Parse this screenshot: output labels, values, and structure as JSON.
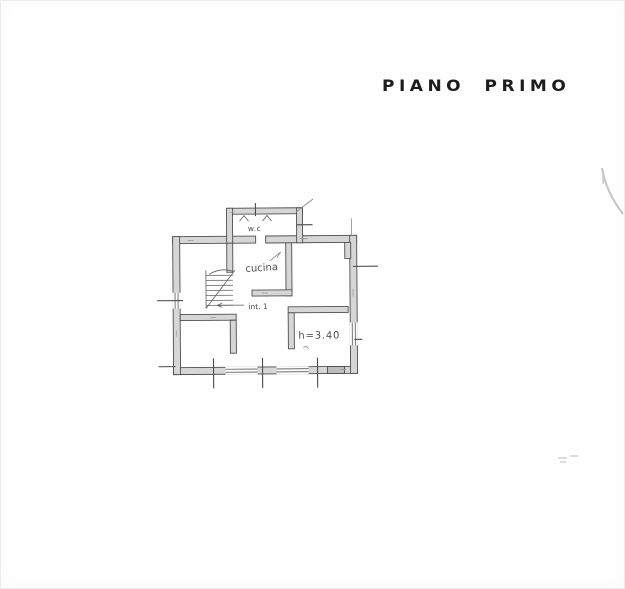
{
  "title": {
    "text": "PIANO PRIMO"
  },
  "floor_plan": {
    "labels": {
      "wc": "w.c",
      "kitchen": "cucina",
      "unit": "int. 1",
      "ceiling_height": "h=3.40"
    },
    "colors": {
      "paper": "#fefefe",
      "wall_fill": "#d6d6d6",
      "wall_stroke": "#4f4f4f",
      "title_ink": "#1d1d1d",
      "label_ink": "#4e4e4e"
    }
  }
}
